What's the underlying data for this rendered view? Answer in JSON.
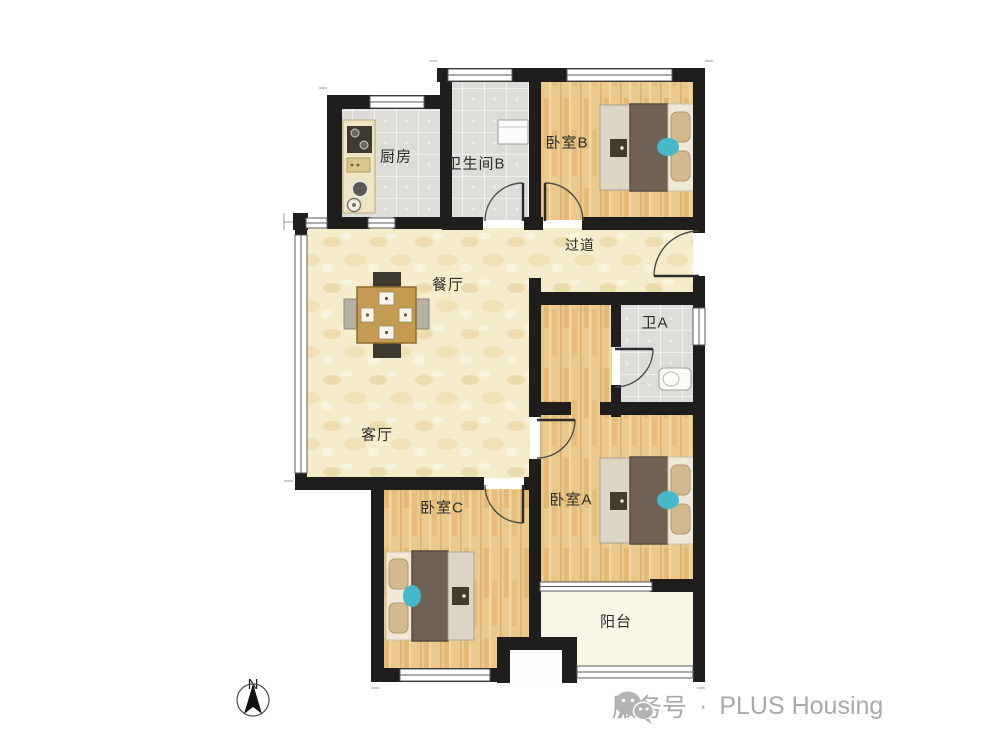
{
  "plan": {
    "rooms": {
      "kitchen": {
        "label": "厨房"
      },
      "bathroom_b": {
        "label": "卫生间B"
      },
      "bedroom_b": {
        "label": "卧室B"
      },
      "hallway": {
        "label": "过道"
      },
      "dining": {
        "label": "餐厅"
      },
      "bathroom_a": {
        "label": "卫A"
      },
      "living": {
        "label": "客厅"
      },
      "bedroom_c": {
        "label": "卧室C"
      },
      "bedroom_a": {
        "label": "卧室A"
      },
      "balcony": {
        "label": "阳台"
      }
    },
    "compass": {
      "north_label": "N"
    }
  },
  "footer": {
    "account_type": "服务号",
    "separator": "·",
    "brand": "PLUS Housing"
  },
  "colors": {
    "wall": "#1f1e1c",
    "floor_wood": "#eac288",
    "floor_cream": "#f4ecca",
    "floor_tile": "#dddcd8",
    "floor_balcony": "#f8f4e6",
    "accent_cyan": "#47b7cc",
    "footer_gray": "#a9a9a9"
  }
}
